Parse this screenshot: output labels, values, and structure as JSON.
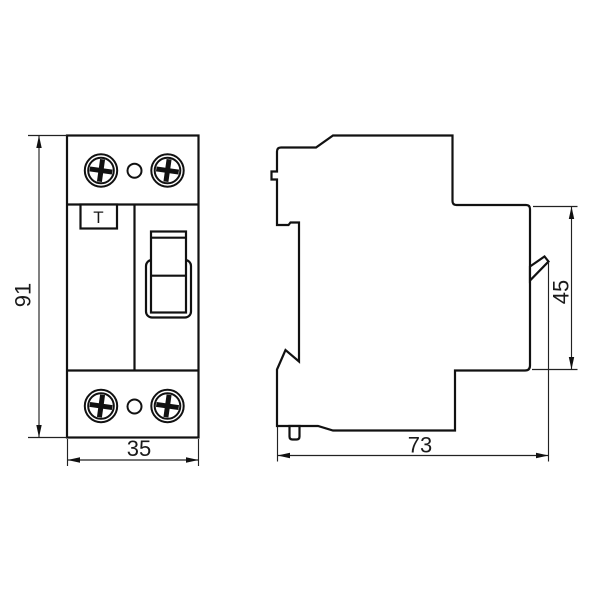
{
  "drawing": {
    "background_color": "#ffffff",
    "line_color": "#111111",
    "front_view": {
      "test_button_label": "T"
    },
    "dimensions": {
      "height": {
        "label": "91"
      },
      "width": {
        "label": "35"
      },
      "depth": {
        "label": "73"
      },
      "rail_height": {
        "label": "45"
      }
    }
  }
}
